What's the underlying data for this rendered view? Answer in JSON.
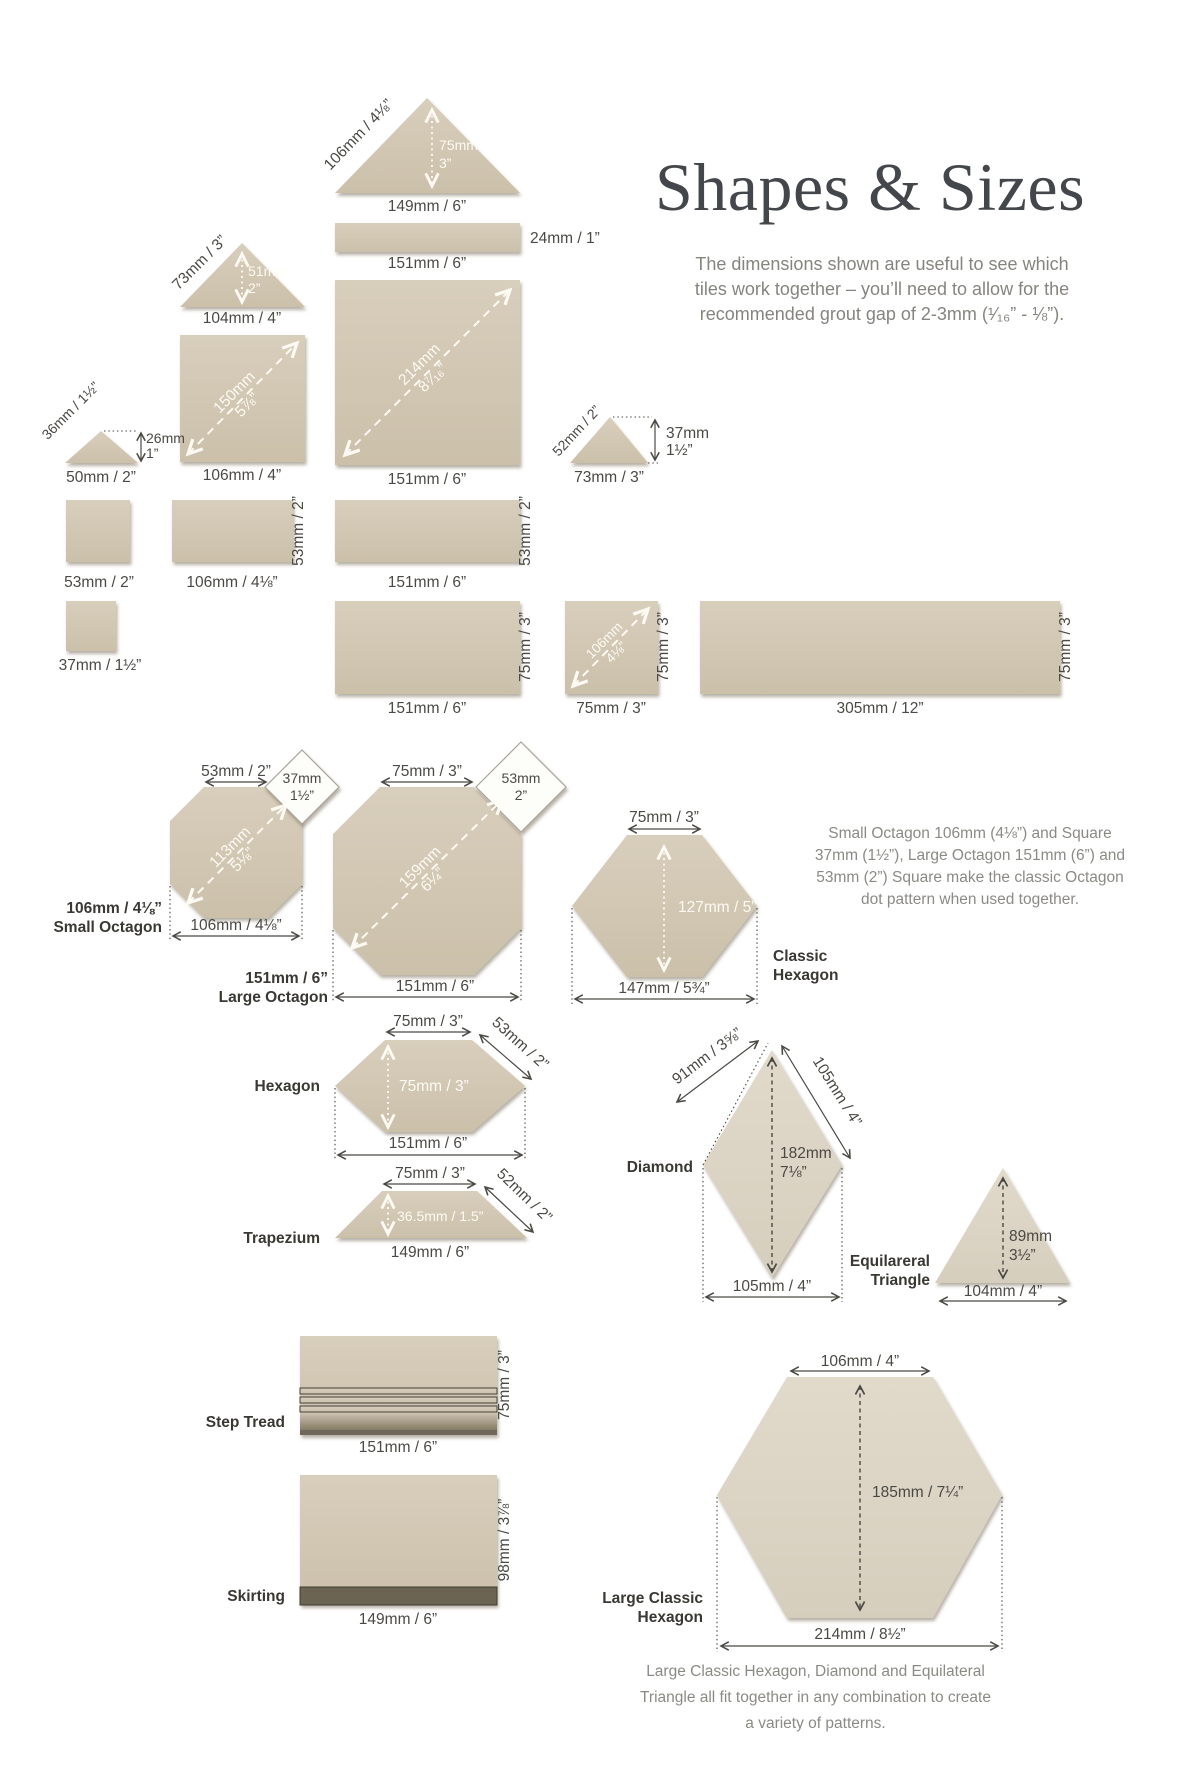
{
  "header": {
    "title": "Shapes & Sizes",
    "subtitle": [
      "The dimensions shown are useful to see which",
      "tiles work together – you’ll need to allow for the",
      "recommended grout gap of 2-3mm (¹⁄₁₆” - ⅛”)."
    ]
  },
  "notes": {
    "octagon": [
      "Small Octagon 106mm (4⅛”) and Square",
      "37mm (1½”), Large Octagon 151mm (6”) and",
      "53mm (2”) Square make the classic Octagon",
      "dot pattern when used together."
    ],
    "footer": [
      "Large Classic Hexagon, Diamond and Equilateral",
      "Triangle all fit together in any combination to create",
      "a variety of patterns."
    ]
  },
  "colors": {
    "tile": "#d3c8b3",
    "tile_light": "#ded7c7",
    "trim_dark": "#6d6454",
    "dim_text": "#4b4944",
    "muted_text": "#8b8a85",
    "title_text": "#43464a"
  },
  "shapes": {
    "tri149": {
      "side": "106mm / 4⅛”",
      "h": [
        "75mm",
        "3”"
      ],
      "base": "149mm / 6”"
    },
    "rect24": {
      "h": "24mm / 1”",
      "w": "151mm / 6”"
    },
    "sq151": {
      "diag": [
        "214mm",
        "8⁷⁄₁₆”"
      ],
      "base": "151mm / 6”"
    },
    "tri104": {
      "side": "73mm / 3”",
      "h": [
        "51mm",
        "2”"
      ],
      "base": "104mm / 4”"
    },
    "sq106": {
      "diag": [
        "150mm",
        "5⅞”"
      ],
      "base": "106mm / 4”"
    },
    "tri50": {
      "side": "36mm / 1½”",
      "h": [
        "26mm",
        "1”"
      ],
      "base": "50mm / 2”"
    },
    "tri73": {
      "side": "52mm / 2”",
      "h": [
        "37mm",
        "1½”"
      ],
      "base": "73mm / 3”"
    },
    "sq53": {
      "label": "53mm / 2”"
    },
    "rect106x53": {
      "base": "106mm / 4⅛”",
      "side": "53mm / 2”"
    },
    "rect151x53": {
      "base": "151mm / 6”",
      "side": "53mm / 2”"
    },
    "sq37": {
      "label": "37mm / 1½”"
    },
    "rect151x75": {
      "base": "151mm / 6”",
      "side": "75mm / 3”"
    },
    "sq75": {
      "diag": [
        "106mm",
        "4⅛”"
      ],
      "base": "75mm / 3”",
      "side": "75mm / 3”"
    },
    "rect305": {
      "base": "305mm / 12”",
      "side": "75mm / 3”"
    },
    "small_octagon": {
      "top": "53mm / 2”",
      "dot": [
        "37mm",
        "1½”"
      ],
      "diag": [
        "113mm",
        "5⅛”"
      ],
      "width": "106mm / 4⅛”",
      "label": [
        "106mm / 4⅛”",
        "Small Octagon"
      ]
    },
    "large_octagon": {
      "top": "75mm / 3”",
      "dot": [
        "53mm",
        "2”"
      ],
      "diag": [
        "159mm",
        "6¼”"
      ],
      "width": "151mm / 6”",
      "label": [
        "151mm / 6”",
        "Large Octagon"
      ]
    },
    "classic_hexagon": {
      "top": "75mm / 3”",
      "height": "127mm / 5”",
      "width": "147mm / 5¾”",
      "label": [
        "Classic",
        "Hexagon"
      ]
    },
    "hexagon": {
      "label": "Hexagon",
      "top": "75mm / 3”",
      "side": "53mm / 2”",
      "height": "75mm / 3”",
      "width": "151mm / 6”"
    },
    "trapezium": {
      "label": "Trapezium",
      "top": "75mm / 3”",
      "side": "52mm / 2”",
      "height": "36.5mm / 1.5”",
      "base": "149mm / 6”"
    },
    "diamond": {
      "label": "Diamond",
      "side_left": "91mm / 3⅝”",
      "side_right": "105mm / 4”",
      "height": [
        "182mm",
        "7⅛”"
      ],
      "width": "105mm / 4”"
    },
    "equilateral_triangle": {
      "label": [
        "Equilareral",
        "Triangle"
      ],
      "height": [
        "89mm",
        "3½”"
      ],
      "base": "104mm / 4”"
    },
    "step_tread": {
      "label": "Step Tread",
      "side": "75mm / 3”",
      "base": "151mm / 6”"
    },
    "skirting": {
      "label": "Skirting",
      "side": "98mm / 3⅞”",
      "base": "149mm / 6”"
    },
    "large_classic_hexagon": {
      "label": [
        "Large Classic",
        "Hexagon"
      ],
      "top": "106mm / 4”",
      "height": "185mm / 7¼”",
      "width": "214mm / 8½”"
    }
  }
}
